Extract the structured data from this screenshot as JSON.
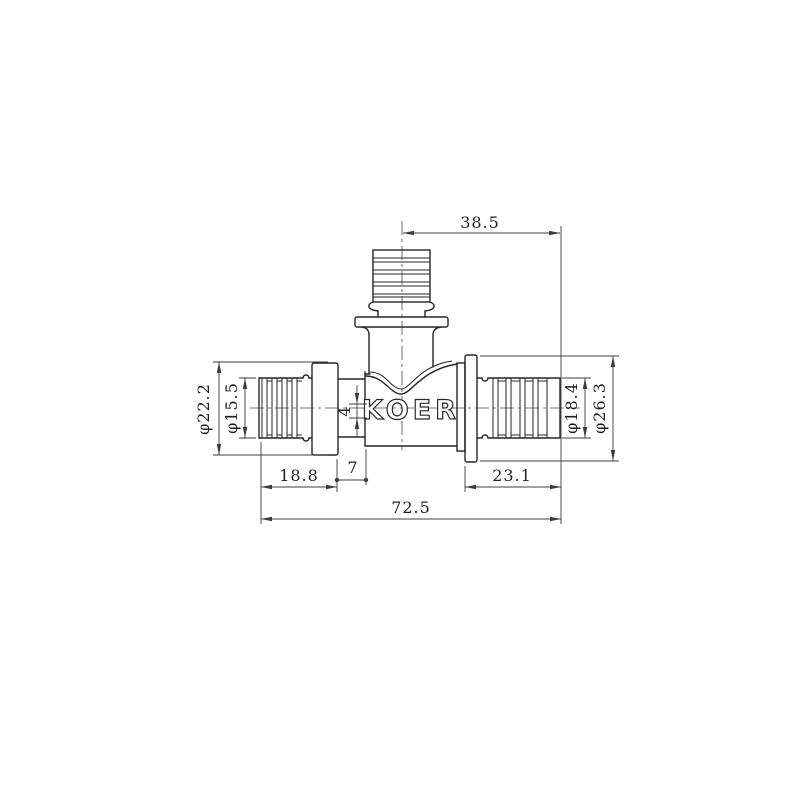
{
  "drawing": {
    "type": "technical-drawing",
    "subject": "pex-tee-pipe-fitting",
    "brand": "KOER",
    "line_color": "#262626",
    "dim_color": "#3c3c3c",
    "background": "#ffffff",
    "labels": {
      "top_branch_offset": "38.5",
      "left_outer_diameter": "φ22.2",
      "left_insert_diameter": "φ15.5",
      "wall_step": "4",
      "left_insert_length": "18.8",
      "left_neck_length": "7",
      "right_insert_length": "23.1",
      "overall_length": "72.5",
      "right_insert_diameter": "φ18.4",
      "right_outer_diameter": "φ26.3"
    }
  }
}
